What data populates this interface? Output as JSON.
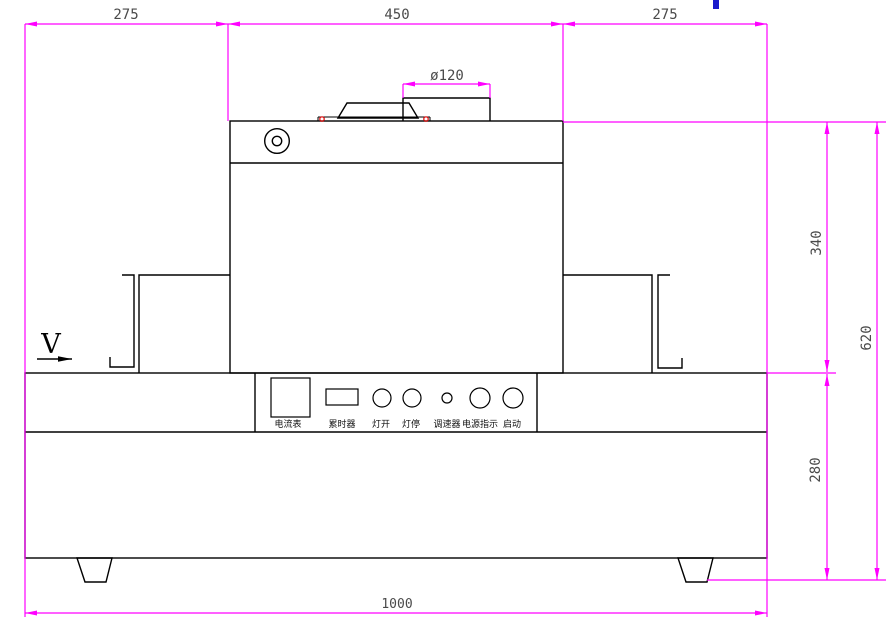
{
  "dims": {
    "top_left": "275",
    "top_center": "450",
    "top_right": "275",
    "duct": "ø120",
    "tunnel_height": "340",
    "base_height": "280",
    "total_height": "620",
    "base_width": "1000"
  },
  "labels": {
    "direction": "V",
    "panel": [
      "电流表",
      "累时器",
      "灯开",
      "灯停",
      "调速器",
      "电源指示",
      "启动"
    ]
  },
  "colors": {
    "dimension_line": "#ff00ff",
    "dim_text": "#4a4a4a",
    "outline": "#000000",
    "marker_red": "#e00000",
    "cursor_blue": "#1a1acc"
  }
}
